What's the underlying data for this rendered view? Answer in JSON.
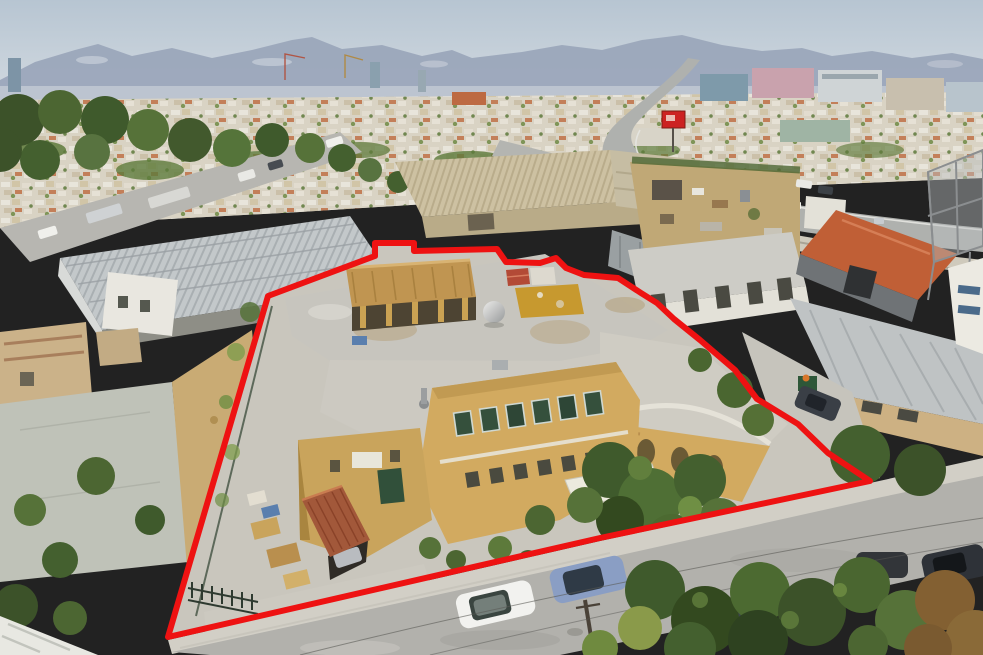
{
  "image": {
    "title": "Aerial drone photo of a cream industrial warehouse complex outlined with a thick red property boundary, city and mountains on the horizon, highway at right, pine trees and parked cars on the street in front",
    "width_px": 983,
    "height_px": 655
  },
  "palette": {
    "sky_top": "#b7c5d2",
    "sky_horizon": "#d4dbe1",
    "mountains": "#9ba7bb",
    "mountain_light": "#c3cad6",
    "city_base": "#d9d3c4",
    "tree_dark": "#3c5229",
    "tree_mid": "#567239",
    "tree_light": "#6f8f44",
    "dry_tree_brown": "#836032",
    "dry_ground": "#c4a266",
    "concrete": "#c9c6bd",
    "sidewalk": "#d2cfc6",
    "asphalt": "#b2b1ac",
    "roof_gray": "#c7c5be",
    "roof_stain": "#b59f78",
    "wall_yellow": "#d2aa60",
    "wall_yellow_shade": "#b08c48",
    "canopy_tan": "#c09551",
    "rust_roof": "#a2583a",
    "orange_roof": "#c05f36",
    "red_shed": "#b34a36",
    "mustard_box": "#c7992f",
    "highway": "#afb1ae",
    "white_wall": "#eceae2",
    "boundary_red": "#ee1212"
  },
  "boundary": {
    "color": "#ee1212",
    "stroke_width": 6,
    "points": "268,296 375,256 375,243 414,243 414,251 497,249 506,262 540,263 556,258 566,268 584,275 618,278 641,293 657,303 674,319 700,340 735,370 757,399 798,424 828,453 870,481 600,538 168,637"
  },
  "scene": {
    "setting": "city outskirts, hazy mountains on horizon, dense low-rise city band",
    "subject": "flat-roofed industrial complex with ochre walls, tan pitched canopy, rooftop tank and mustard skylight box, rusty garage roof, gated yard",
    "right_side": "neighbouring warehouses with orange and corrugated grey roofs, empty billboard frame, curving highway",
    "left_side": "long grey warehouse, pine-lined road with parked trucks and cars, small tan outbuildings",
    "foreground": "asphalt street with sidewalk, utility pole and wires, large pine canopies",
    "vehicles": [
      {
        "name": "white-hatchback",
        "location": "front street"
      },
      {
        "name": "blue-grey-hatchback",
        "location": "front street"
      },
      {
        "name": "silver-sedan",
        "location": "front street lower right"
      },
      {
        "name": "dark-suv",
        "location": "right edge under pines"
      },
      {
        "name": "dark-sedan",
        "location": "side alley right of property"
      },
      {
        "name": "car-inside-garage",
        "location": "under rusty garage roof"
      },
      {
        "name": "parked-trucks-and-cars-row",
        "location": "tree-lined road upper left"
      },
      {
        "name": "small-white-vans",
        "location": "highway"
      }
    ]
  }
}
